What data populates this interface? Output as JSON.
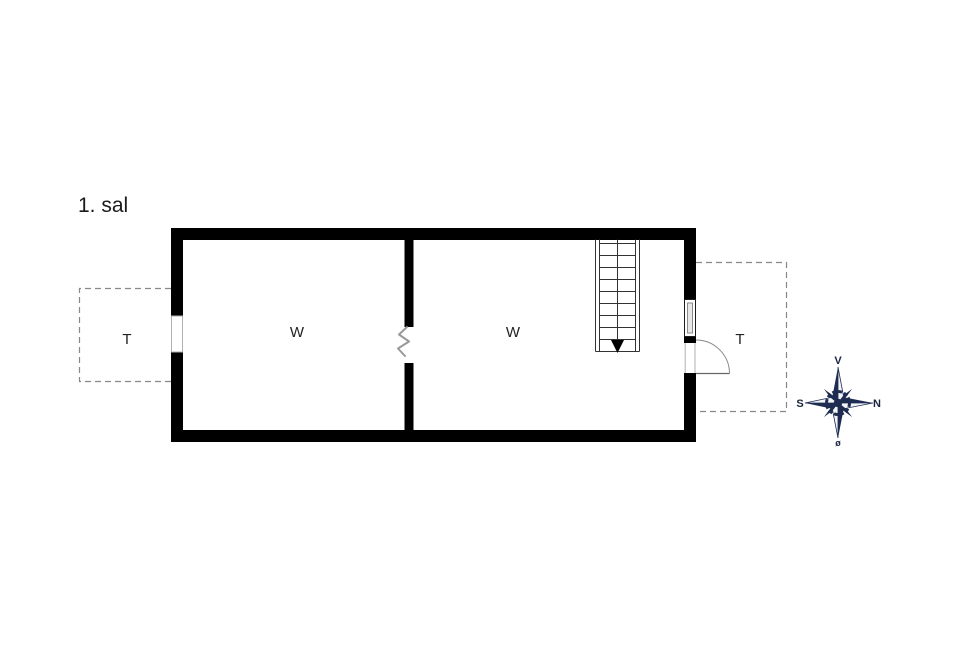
{
  "floorplan": {
    "floor_label": "1. sal",
    "rooms": [
      {
        "label": "W"
      },
      {
        "label": "W"
      }
    ],
    "terraces": [
      {
        "label": "T",
        "side": "west"
      },
      {
        "label": "T",
        "side": "east"
      }
    ],
    "stair": {
      "steps": 9,
      "direction": "down"
    },
    "compass": {
      "top": "V",
      "right": "N",
      "left": "S",
      "bottom": "ø",
      "color": "#1e2c51"
    },
    "colors": {
      "wall": "#000000",
      "dashed_outline": "#888888",
      "opening_zigzag": "#999999",
      "stair_lines": "#333333"
    }
  }
}
